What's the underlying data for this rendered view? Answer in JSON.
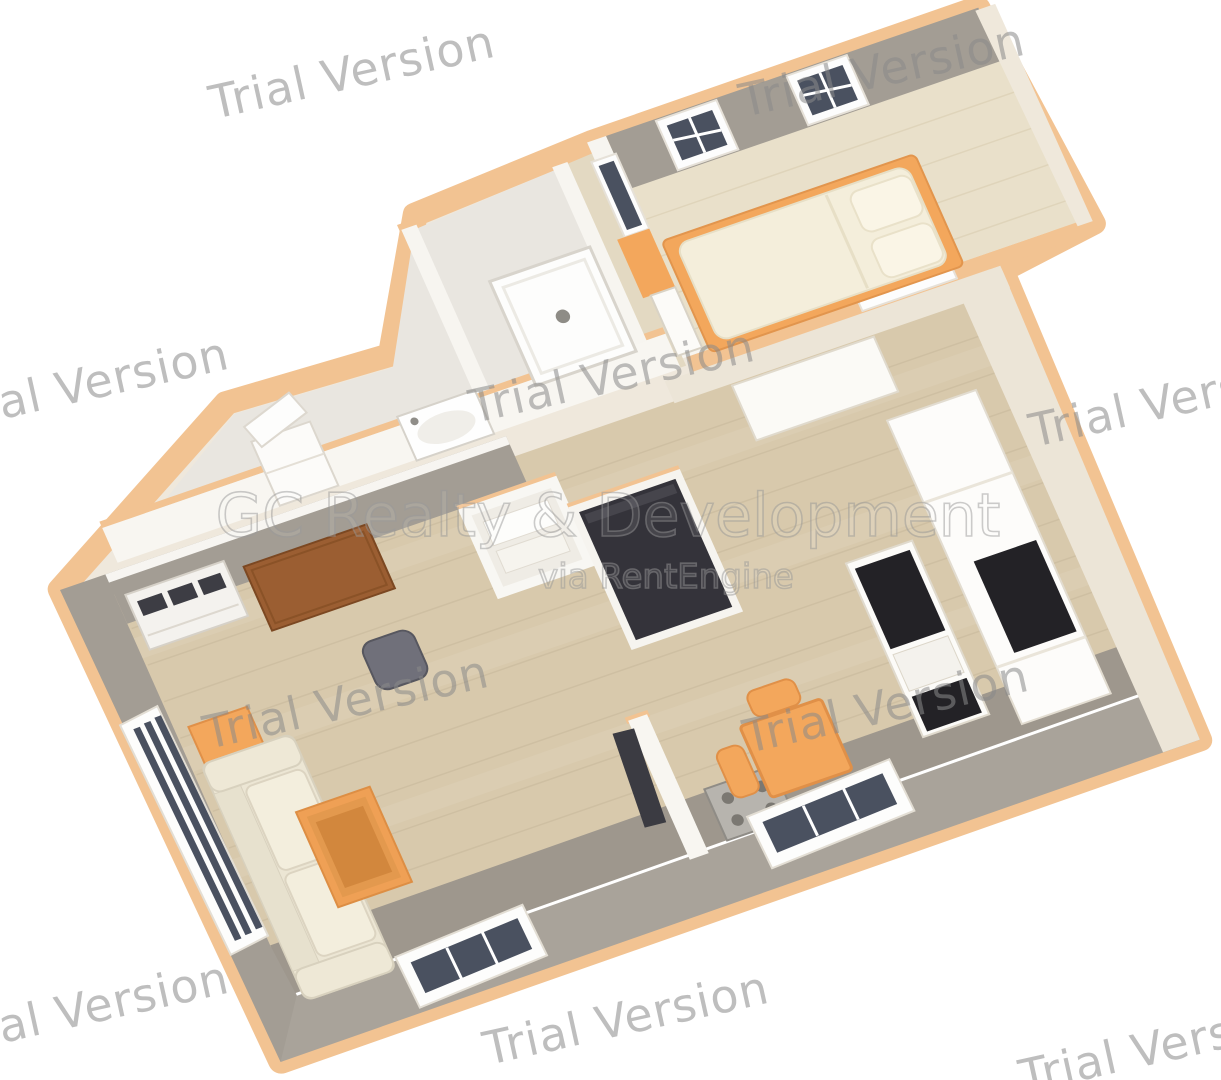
{
  "watermarks": {
    "items": [
      {
        "text": "Trial Version"
      },
      {
        "text": "Trial Version"
      },
      {
        "text": "Trial Version"
      },
      {
        "text": "Trial Version"
      },
      {
        "text": "Trial Version"
      },
      {
        "text": "Trial Version"
      },
      {
        "text": "Trial Version"
      },
      {
        "text": "Trial Version"
      },
      {
        "text": "Trial Version"
      },
      {
        "text": "Trial Version"
      }
    ]
  },
  "branding": {
    "line1": "GC Realty & Development",
    "line2": "via RentEngine"
  },
  "palette": {
    "trim": "#f2c392",
    "wall_gray": "#a39d94",
    "wall_gray2": "#a9a39a",
    "wall_cream": "#efe8dc",
    "wall_cream2": "#ece5d7",
    "wood": "#d8c9ac",
    "wood_pale": "#e9e0ca",
    "wood_corridor": "#e3d9c2",
    "bath_floor": "#e9e6e0",
    "floor_gray": "#9e978d",
    "orange": "#f3a75c",
    "orange_deep": "#e09048",
    "brown": "#9b5e32",
    "dark": "#34333a",
    "counter": "#232226",
    "glass": "#4a5160",
    "watermark": "#8a8a8a",
    "brand_stroke": "#9a9a9a"
  },
  "scene": {
    "type": "3d-floor-plan-render",
    "rooms": [
      "living-room",
      "kitchen",
      "dining-area",
      "bathroom",
      "bedroom",
      "corridor",
      "entry",
      "white-closet",
      "dark-closet"
    ],
    "furniture": [
      "sofa",
      "coffee-table",
      "side-table",
      "desk",
      "office-chair",
      "heater-unit",
      "double-bed",
      "pillows",
      "shower",
      "bathroom-sink",
      "bathroom-cabinet",
      "dining-table",
      "dining-chairs",
      "stove",
      "kitchen-island",
      "kitchen-cabinets",
      "windows"
    ]
  }
}
